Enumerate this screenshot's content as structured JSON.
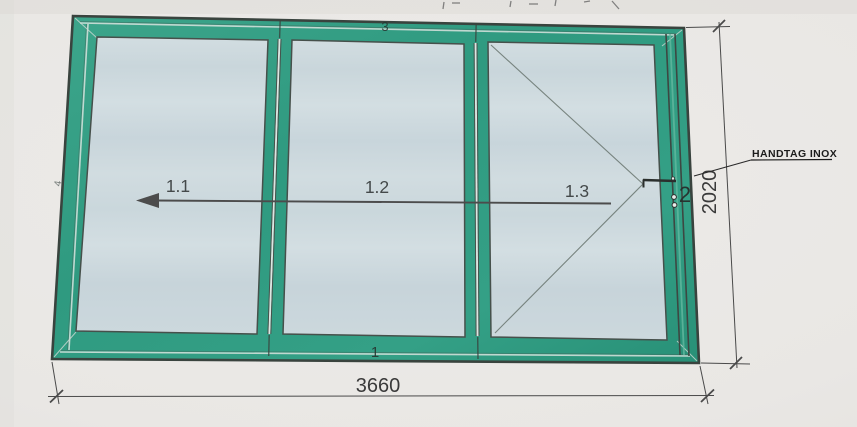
{
  "drawing": {
    "panels": [
      {
        "label": "1.1"
      },
      {
        "label": "1.2"
      },
      {
        "label": "1.3"
      }
    ],
    "dimensions": {
      "width": "3660",
      "height": "2020"
    },
    "handle_note": "HANDTAG INOX",
    "member_marks": {
      "bottom": "1",
      "right": "2",
      "top": "3",
      "left": "4"
    },
    "symbols": {
      "slide_arrow": "left-direction-arrow",
      "swing_lines": "hinged-panel-swing",
      "handle": "door-handle"
    },
    "colors": {
      "frame_green": "#35a086",
      "frame_green_dark": "#289077",
      "glass_blue": "#ccd8dd",
      "outline": "#39433e",
      "dim_line": "#4a4a4a",
      "text": "#3a3a3a",
      "paper": "#e9e7e4"
    }
  }
}
